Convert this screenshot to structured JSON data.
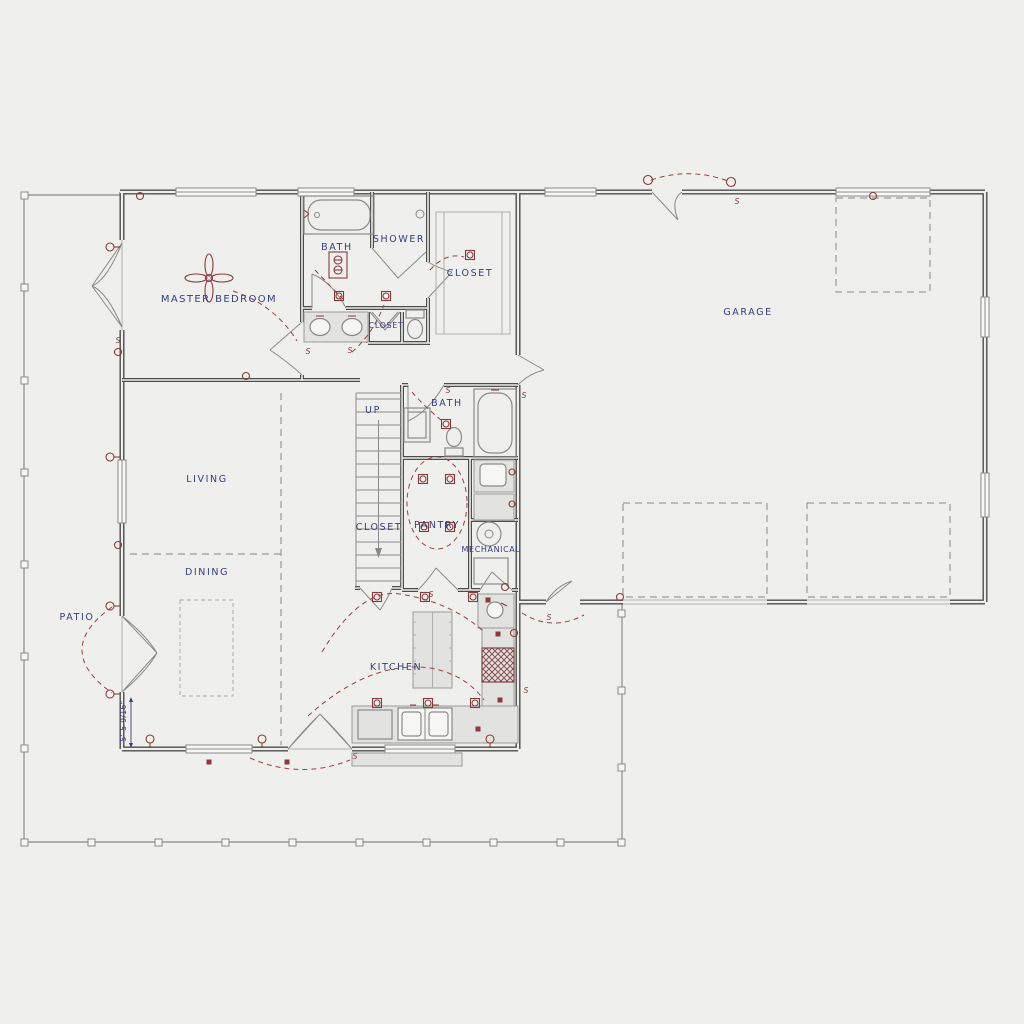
{
  "plan": {
    "labels": {
      "master_bedroom": "MASTER BEDROOM",
      "master_bath": "BATH",
      "shower": "SHOWER",
      "walkin_closet": "CLOSET",
      "linen_closet": "CLOSET",
      "stairs_up": "UP",
      "hall_bath": "BATH",
      "stair_closet": "CLOSET",
      "pantry": "PANTRY",
      "mechanical": "MECHANICAL",
      "living": "LIVING",
      "dining": "DINING",
      "kitchen": "KITCHEN",
      "garage": "GARAGE",
      "patio": "PATIO"
    },
    "dimensions": {
      "patio_depth": "5'-5 9/16\""
    },
    "symbols": {
      "switch": "S"
    },
    "colors": {
      "background": "#efefed",
      "wall": "#4d4d4d",
      "room_label": "#35407d",
      "electrical": "#8a3b3b",
      "fixture_outline": "#8a8a88",
      "counter_fill": "#e2e2e0",
      "porch_line": "#9a9a98"
    }
  }
}
